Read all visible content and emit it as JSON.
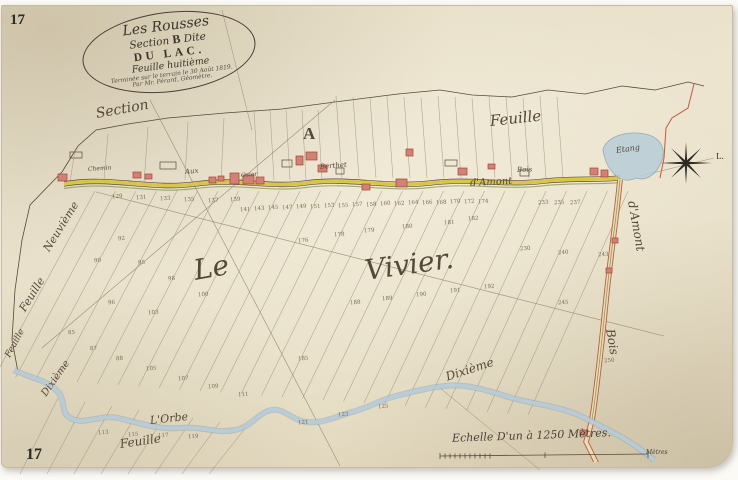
{
  "page": {
    "sheet_number_top": "17",
    "sheet_number_bottom": "17"
  },
  "cartouche": {
    "line1": "Les Rousses",
    "line2_a": "Section",
    "line2_b": "B",
    "line2_c": "Dite",
    "line3": "DU LAC.",
    "line4": "Feuille huitième",
    "line5": "Terminée sur le terrain le 30 Août 1819.",
    "line6": "Par Mr. Pérard, Géomètre."
  },
  "compass": {
    "east_label": "L."
  },
  "scale": {
    "caption": "Echelle D'un à 1250 Mètres.",
    "end_label": "Mètres"
  },
  "colors": {
    "ink": "#574a38",
    "road_yellow": "#d9c33f",
    "road_green": "#8a9a55",
    "water_fill": "#b9cdd9",
    "water_edge": "#85a3b5",
    "building_red": "#cf8275",
    "building_edge": "#a84432",
    "boundary_red": "#c05a3c"
  },
  "map_labels": [
    {
      "text": "Section",
      "x": 96,
      "y": 106,
      "rot": -10,
      "size": 14,
      "style": "script"
    },
    {
      "text": "A",
      "x": 303,
      "y": 124,
      "rot": 0,
      "size": 17,
      "style": "bold"
    },
    {
      "text": "Feuille",
      "x": 490,
      "y": 112,
      "rot": -6,
      "size": 15,
      "style": "script"
    },
    {
      "text": "Etang",
      "x": 616,
      "y": 146,
      "rot": -8,
      "size": 8,
      "style": "script"
    },
    {
      "text": "Chemin",
      "x": 88,
      "y": 166,
      "rot": -4,
      "size": 6,
      "style": "script"
    },
    {
      "text": "Aux",
      "x": 185,
      "y": 168,
      "rot": -6,
      "size": 7,
      "style": "script"
    },
    {
      "text": "Osier",
      "x": 241,
      "y": 172,
      "rot": -4,
      "size": 6,
      "style": "script"
    },
    {
      "text": "Berthet",
      "x": 320,
      "y": 163,
      "rot": -5,
      "size": 7,
      "style": "script"
    },
    {
      "text": "Bois",
      "x": 517,
      "y": 166,
      "rot": -2,
      "size": 7,
      "style": "script"
    },
    {
      "text": "d'Amont",
      "x": 470,
      "y": 178,
      "rot": -3,
      "size": 10,
      "style": "script"
    },
    {
      "text": "Le",
      "x": 194,
      "y": 254,
      "rot": -10,
      "size": 28,
      "style": "script"
    },
    {
      "text": "Vivier.",
      "x": 365,
      "y": 254,
      "rot": -8,
      "size": 28,
      "style": "script"
    },
    {
      "text": "d'Amont",
      "x": 632,
      "y": 194,
      "rot": 80,
      "size": 12,
      "style": "script"
    },
    {
      "text": "Bois",
      "x": 610,
      "y": 322,
      "rot": 80,
      "size": 12,
      "style": "script"
    },
    {
      "text": "Neuvième",
      "x": 46,
      "y": 244,
      "rot": -58,
      "size": 11,
      "style": "script"
    },
    {
      "text": "Feuille",
      "x": 22,
      "y": 304,
      "rot": -58,
      "size": 11,
      "style": "script"
    },
    {
      "text": "Feuille",
      "x": 8,
      "y": 352,
      "rot": -62,
      "size": 9,
      "style": "script"
    },
    {
      "text": "Dixième",
      "x": 44,
      "y": 390,
      "rot": -55,
      "size": 10,
      "style": "script"
    },
    {
      "text": "L'Orbe",
      "x": 150,
      "y": 414,
      "rot": -6,
      "size": 11,
      "style": "script"
    },
    {
      "text": "Feuille",
      "x": 120,
      "y": 437,
      "rot": -8,
      "size": 12,
      "style": "script"
    },
    {
      "text": "Dixième",
      "x": 446,
      "y": 370,
      "rot": -18,
      "size": 12,
      "style": "script"
    }
  ],
  "parcel_numbers": [
    [
      240,
      207,
      "141"
    ],
    [
      254,
      206,
      "143"
    ],
    [
      268,
      205,
      "145"
    ],
    [
      282,
      205,
      "147"
    ],
    [
      296,
      204,
      "149"
    ],
    [
      310,
      204,
      "151"
    ],
    [
      324,
      203,
      "153"
    ],
    [
      338,
      203,
      "155"
    ],
    [
      352,
      202,
      "157"
    ],
    [
      366,
      202,
      "158"
    ],
    [
      380,
      201,
      "160"
    ],
    [
      394,
      201,
      "162"
    ],
    [
      408,
      200,
      "164"
    ],
    [
      422,
      200,
      "166"
    ],
    [
      436,
      200,
      "168"
    ],
    [
      450,
      199,
      "170"
    ],
    [
      464,
      199,
      "172"
    ],
    [
      478,
      199,
      "174"
    ],
    [
      538,
      200,
      "233"
    ],
    [
      554,
      200,
      "235"
    ],
    [
      570,
      200,
      "237"
    ],
    [
      112,
      194,
      "129"
    ],
    [
      136,
      195,
      "131"
    ],
    [
      160,
      196,
      "133"
    ],
    [
      184,
      197,
      "135"
    ],
    [
      208,
      198,
      "137"
    ],
    [
      230,
      197,
      "139"
    ],
    [
      298,
      238,
      "176"
    ],
    [
      334,
      232,
      "178"
    ],
    [
      364,
      228,
      "179"
    ],
    [
      402,
      224,
      "180"
    ],
    [
      444,
      220,
      "181"
    ],
    [
      468,
      216,
      "182"
    ],
    [
      520,
      246,
      "230"
    ],
    [
      558,
      250,
      "240"
    ],
    [
      598,
      252,
      "243"
    ],
    [
      350,
      300,
      "188"
    ],
    [
      382,
      296,
      "189"
    ],
    [
      416,
      292,
      "190"
    ],
    [
      450,
      288,
      "191"
    ],
    [
      484,
      284,
      "192"
    ],
    [
      558,
      300,
      "245"
    ],
    [
      604,
      358,
      "250"
    ],
    [
      298,
      356,
      "185"
    ],
    [
      118,
      236,
      "92"
    ],
    [
      94,
      258,
      "90"
    ],
    [
      138,
      260,
      "95"
    ],
    [
      168,
      276,
      "98"
    ],
    [
      198,
      292,
      "100"
    ],
    [
      148,
      310,
      "103"
    ],
    [
      108,
      300,
      "96"
    ],
    [
      68,
      330,
      "85"
    ],
    [
      90,
      346,
      "87"
    ],
    [
      116,
      356,
      "88"
    ],
    [
      146,
      366,
      "105"
    ],
    [
      178,
      376,
      "107"
    ],
    [
      208,
      384,
      "109"
    ],
    [
      238,
      392,
      "111"
    ],
    [
      98,
      430,
      "113"
    ],
    [
      128,
      432,
      "115"
    ],
    [
      158,
      433,
      "117"
    ],
    [
      188,
      434,
      "119"
    ],
    [
      298,
      420,
      "121"
    ],
    [
      338,
      412,
      "123"
    ],
    [
      378,
      404,
      "125"
    ]
  ]
}
